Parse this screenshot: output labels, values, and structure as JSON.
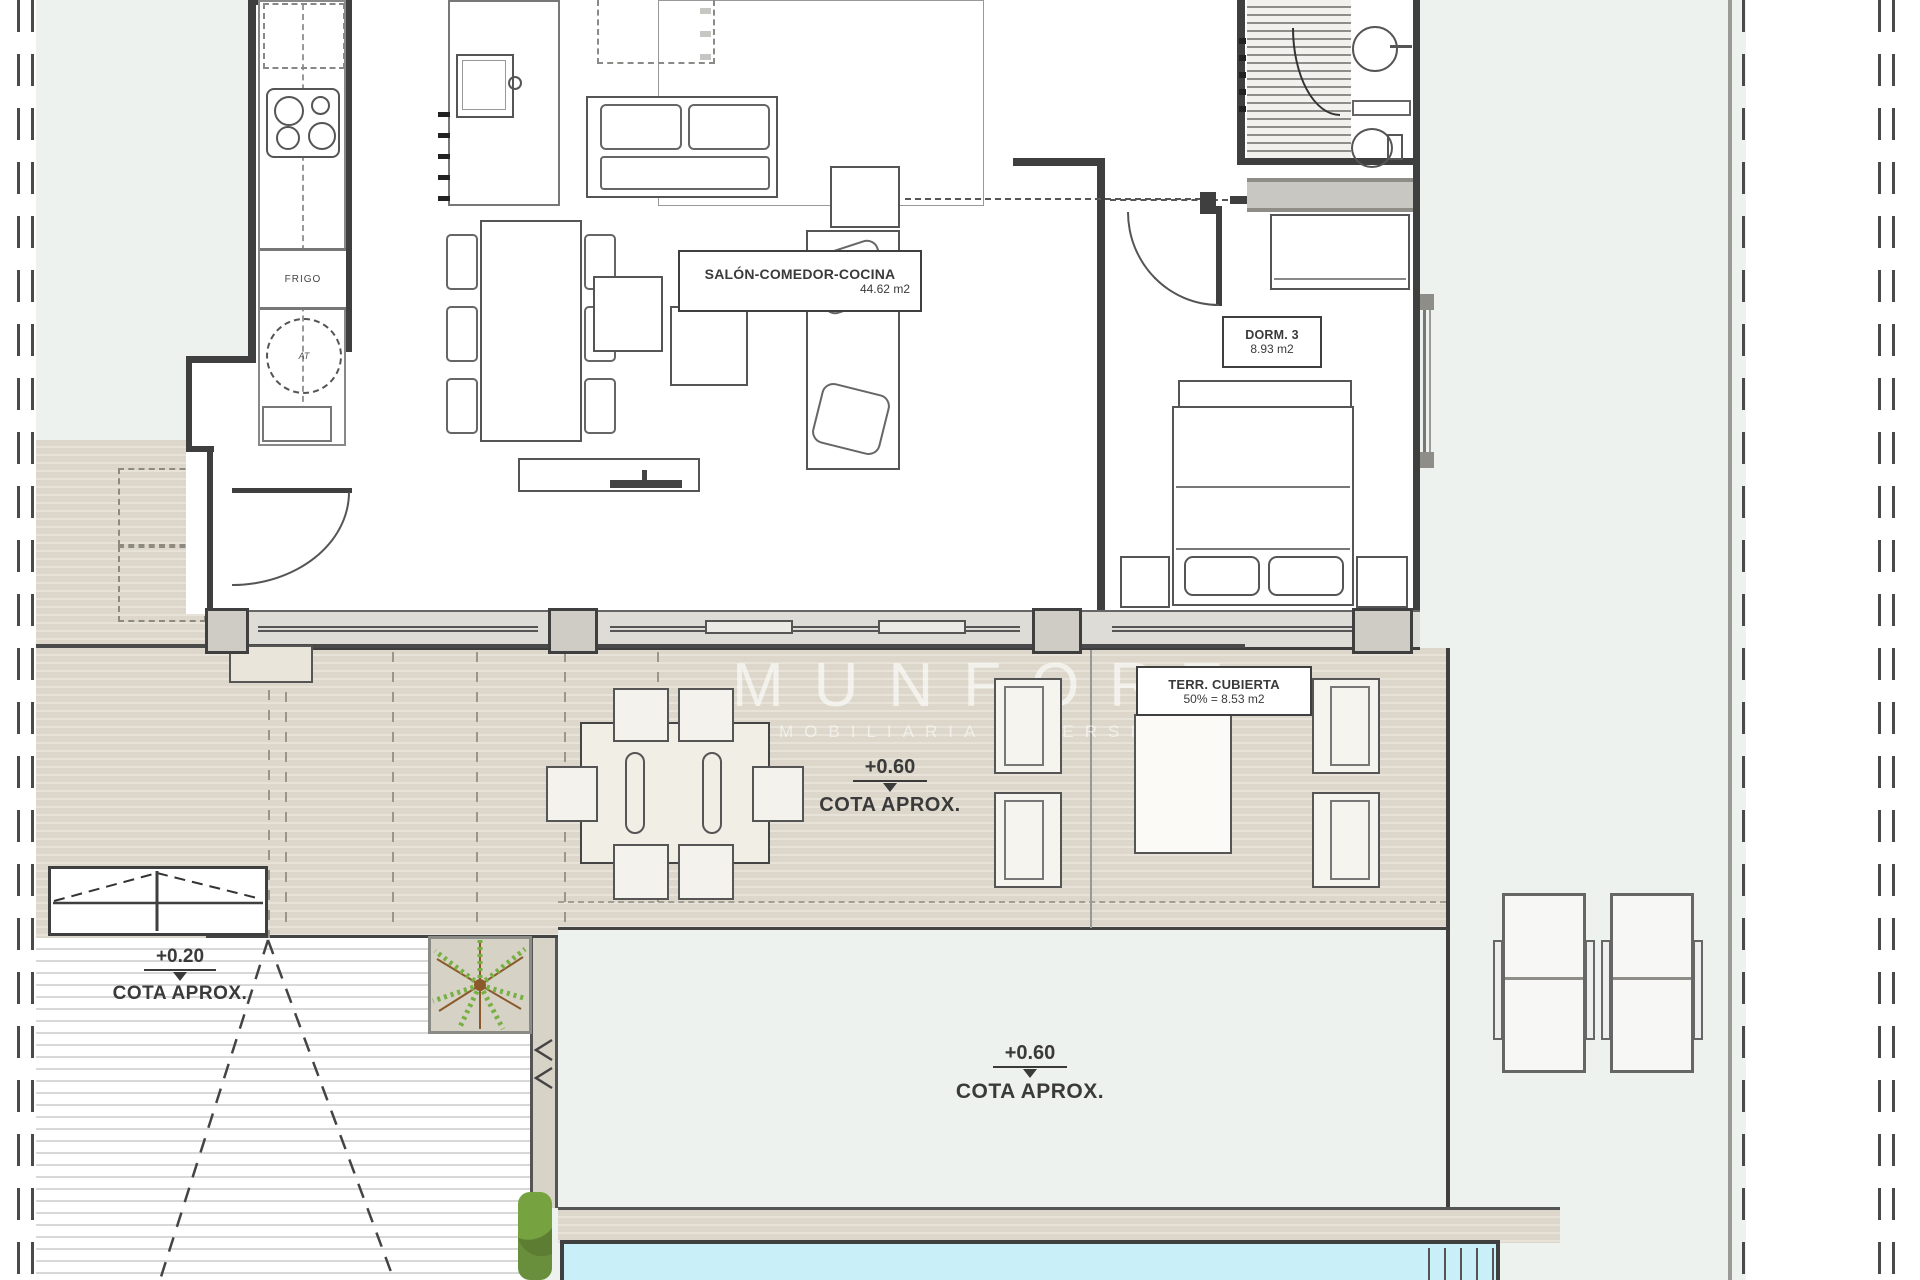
{
  "watermark": {
    "title": "MUNFORT",
    "subtitle": "INMOBILIARIA INVERSION"
  },
  "labels": {
    "living": {
      "name": "SALÓN-COMEDOR-COCINA",
      "area": "44.62 m2"
    },
    "bedroom": {
      "name": "DORM. 3",
      "area": "8.93 m2"
    },
    "covered_terrace": {
      "name": "TERR. CUBIERTA",
      "area": "50% = 8.53 m2"
    }
  },
  "levels": {
    "terrace": {
      "value": "+0.60",
      "caption": "COTA APROX."
    },
    "entry": {
      "value": "+0.20",
      "caption": "COTA APROX."
    },
    "garden": {
      "value": "+0.60",
      "caption": "COTA APROX."
    }
  },
  "appliances": {
    "fridge": "FRIGO",
    "washer": "AT"
  },
  "colors": {
    "background": "#edf2ee",
    "deck": "#dcd7ca",
    "pool": "#c9f0f9",
    "wall": "#3f3f3f",
    "tree": "#76b043"
  }
}
